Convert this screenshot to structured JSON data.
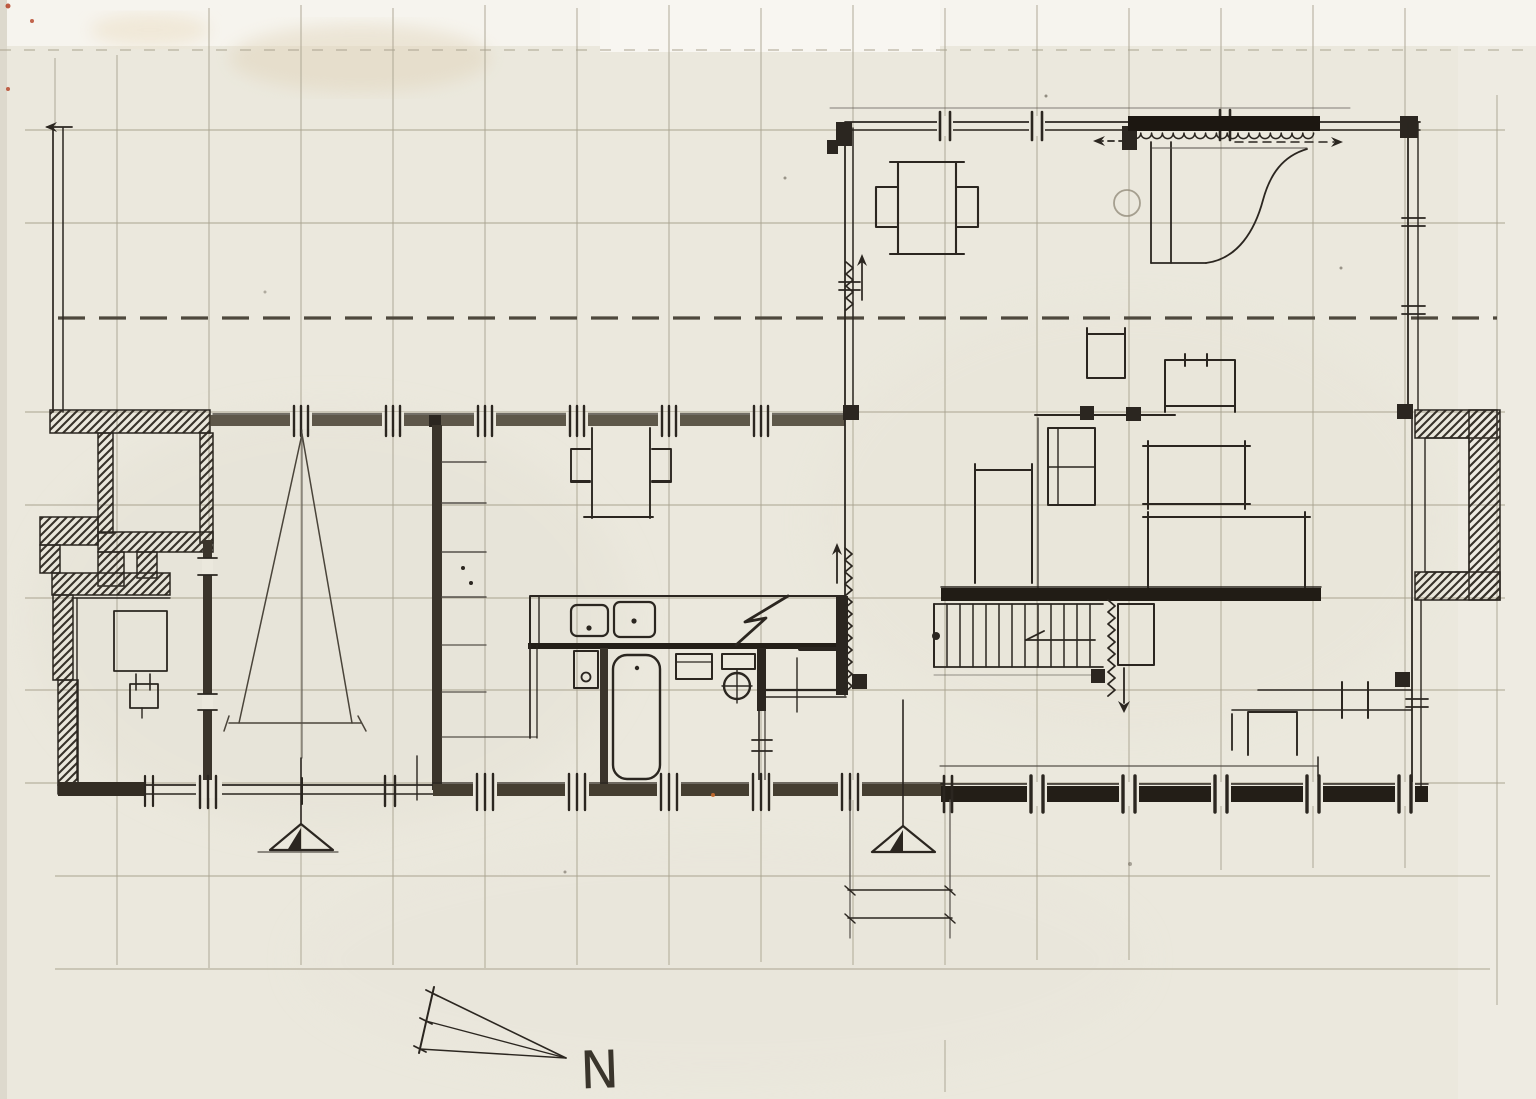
{
  "document": {
    "type": "hand-drawn architectural floor plan, ink and pencil on paper",
    "annotations": {
      "north_label": "N"
    }
  },
  "palette": {
    "paper": "#ebe8dd",
    "paper_light": "#f6f4ee",
    "ink": "#2b2620",
    "wall_smudge": "#453e31",
    "pencil": "#55504a",
    "grid_pencil": "#aaa491",
    "stain_tan": "#e0d3b8",
    "speck_red": "#b43e22",
    "speck_orange": "#c96b2d"
  },
  "features": [
    "pencil-grid",
    "reference-dashed-line",
    "site-edge-line",
    "entry-masonry-walls",
    "garage-room",
    "turning-triangle",
    "closet-shelves",
    "kitchen-counter",
    "double-sink",
    "stove-flash-symbol",
    "washbasin",
    "bathtub",
    "wc",
    "hall-walls",
    "stair-up-zigzag",
    "living-wing",
    "sliding-door-panel",
    "curtain-scallop",
    "slide-arrows",
    "dining-table",
    "dining-chairs",
    "grand-piano",
    "piano-stool",
    "fireplace-chimney",
    "bedroom-furniture",
    "main-stairs",
    "stair-down-zigzag",
    "under-stair-closet",
    "terrace-bench",
    "structural-columns",
    "bottom-wall",
    "section-marker-a",
    "section-marker-b",
    "dimension-lines",
    "north-arrow"
  ]
}
